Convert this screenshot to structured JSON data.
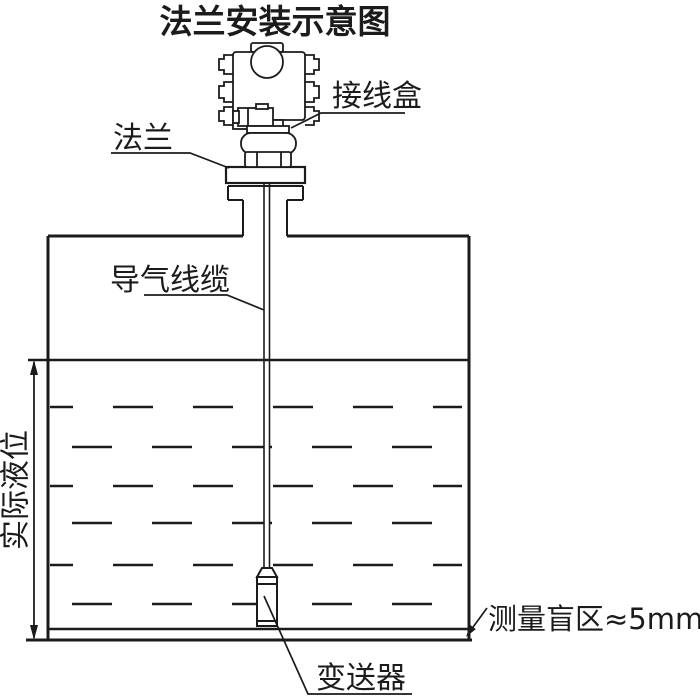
{
  "title": "法兰安装示意图",
  "labels": {
    "junction_box": "接线盒",
    "flange": "法兰",
    "air_cable": "导气线缆",
    "actual_level": "实际液位",
    "transmitter": "变送器",
    "blind_zone": "测量盲区≈5mm"
  },
  "colors": {
    "line": "#1b1b1b",
    "background": "#ffffff"
  }
}
